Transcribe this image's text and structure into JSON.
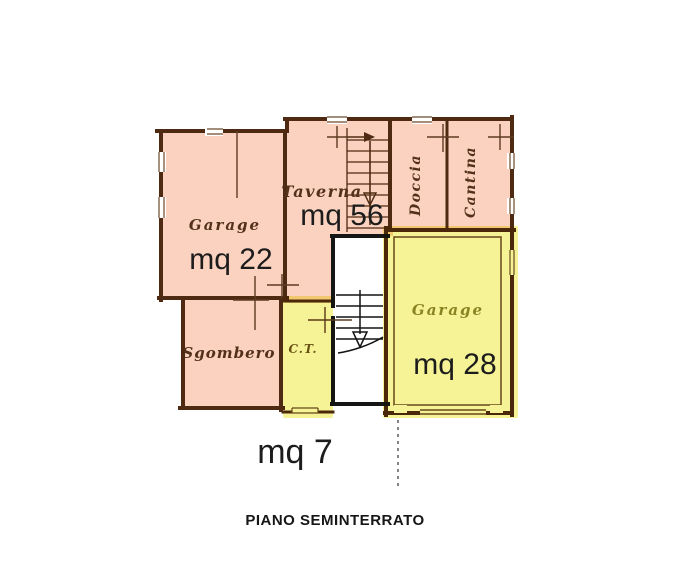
{
  "plan": {
    "title": "PIANO SEMINTERRATO",
    "rooms": [
      {
        "name": "Garage",
        "area": "mq 22",
        "highlight": "pink"
      },
      {
        "name": "Taverna",
        "area": "mq 56",
        "highlight": "pink"
      },
      {
        "name": "Doccia",
        "area": "",
        "highlight": "pink"
      },
      {
        "name": "Cantina",
        "area": "",
        "highlight": "pink"
      },
      {
        "name": "Sgombero",
        "area": "",
        "highlight": "pink"
      },
      {
        "name": "C.T.",
        "area": "mq 7",
        "highlight": "yellow"
      },
      {
        "name": "Garage",
        "area": "mq 28",
        "highlight": "yellow"
      }
    ],
    "colors": {
      "pink_highlight": "#fad2bf",
      "yellow_highlight": "#f2ee8a",
      "wall_brown": "#4f2a12",
      "ink_black": "#1c1c1c"
    }
  }
}
